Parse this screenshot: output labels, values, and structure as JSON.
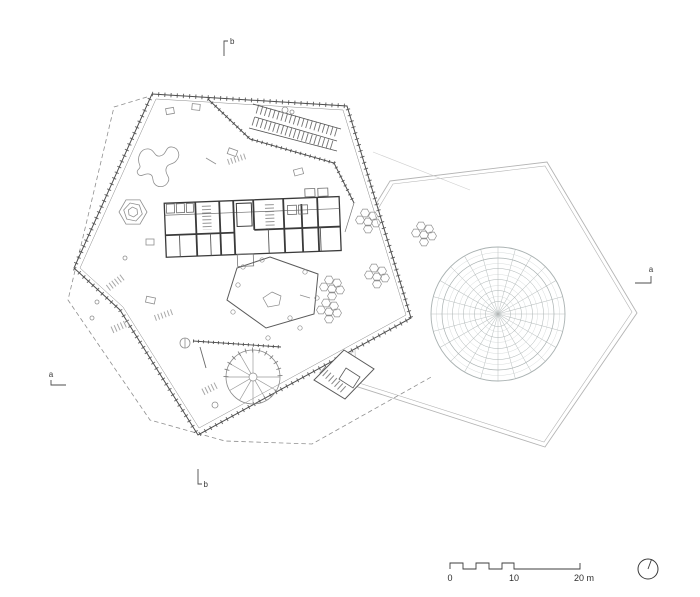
{
  "section_markers": {
    "top": {
      "label": "b"
    },
    "bottom": {
      "label": "b"
    },
    "left": {
      "label": "a"
    },
    "right": {
      "label": "a"
    }
  },
  "scale_bar": {
    "labels": [
      "0",
      "10",
      "20 m"
    ]
  },
  "icons": {
    "north_indicator": "compass-circle-icon"
  },
  "colors": {
    "background": "#ffffff",
    "wall_dark": "#3c3c3c",
    "line_mid": "#6b6b6b",
    "line_light": "#9a9a9a",
    "courtyard_line": "#b4b4b4",
    "dome_mesh": "#b9bfbf",
    "dashed_outline": "#8f8f8f",
    "text": "#3a3a3a"
  }
}
